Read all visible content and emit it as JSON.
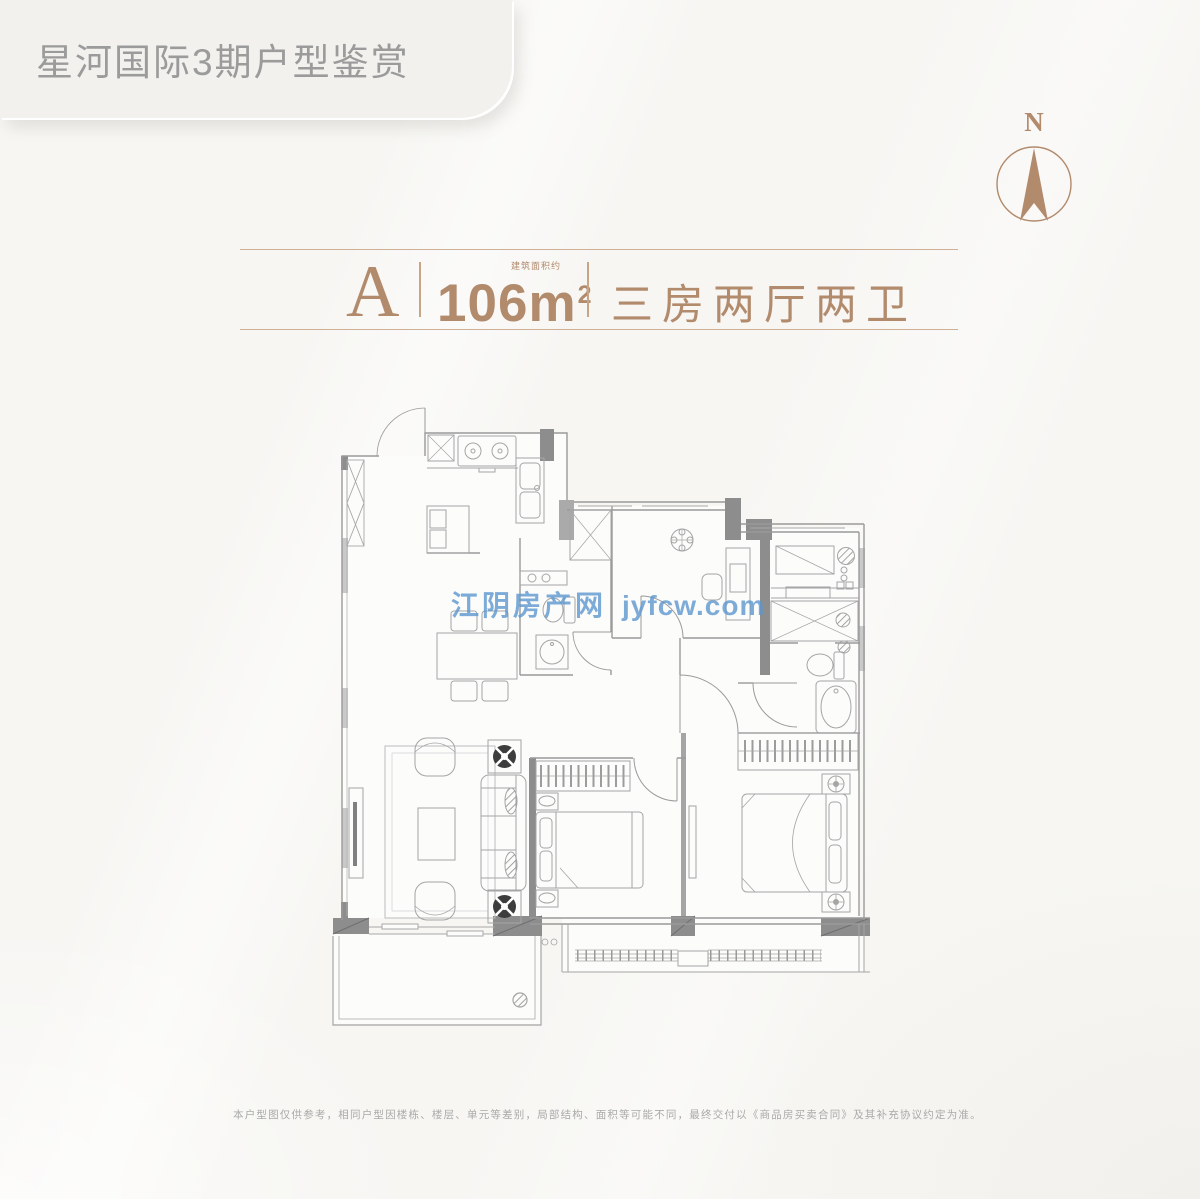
{
  "page": {
    "background": "#f7f6f3",
    "accent_color": "#b28a6c",
    "wall_color": "#9a9a9a",
    "watermark_color": "#5d96d0"
  },
  "badge": {
    "title": "星河国际3期户型鉴赏"
  },
  "compass": {
    "label": "N"
  },
  "unit_title": {
    "unit": "A",
    "area_note": "建筑面积约",
    "area_value": "106",
    "area_unit": "m",
    "area_exponent": "2",
    "layout": "三房两厅两卫"
  },
  "watermark": {
    "site_name": "江阴房产网",
    "site_url": "jyfcw.com"
  },
  "disclaimer": {
    "text": "本户型图仅供参考，相同户型因楼栋、楼层、单元等差别，局部结构、面积等可能不同，最终交付以《商品房买卖合同》及其补充协议约定为准。"
  }
}
